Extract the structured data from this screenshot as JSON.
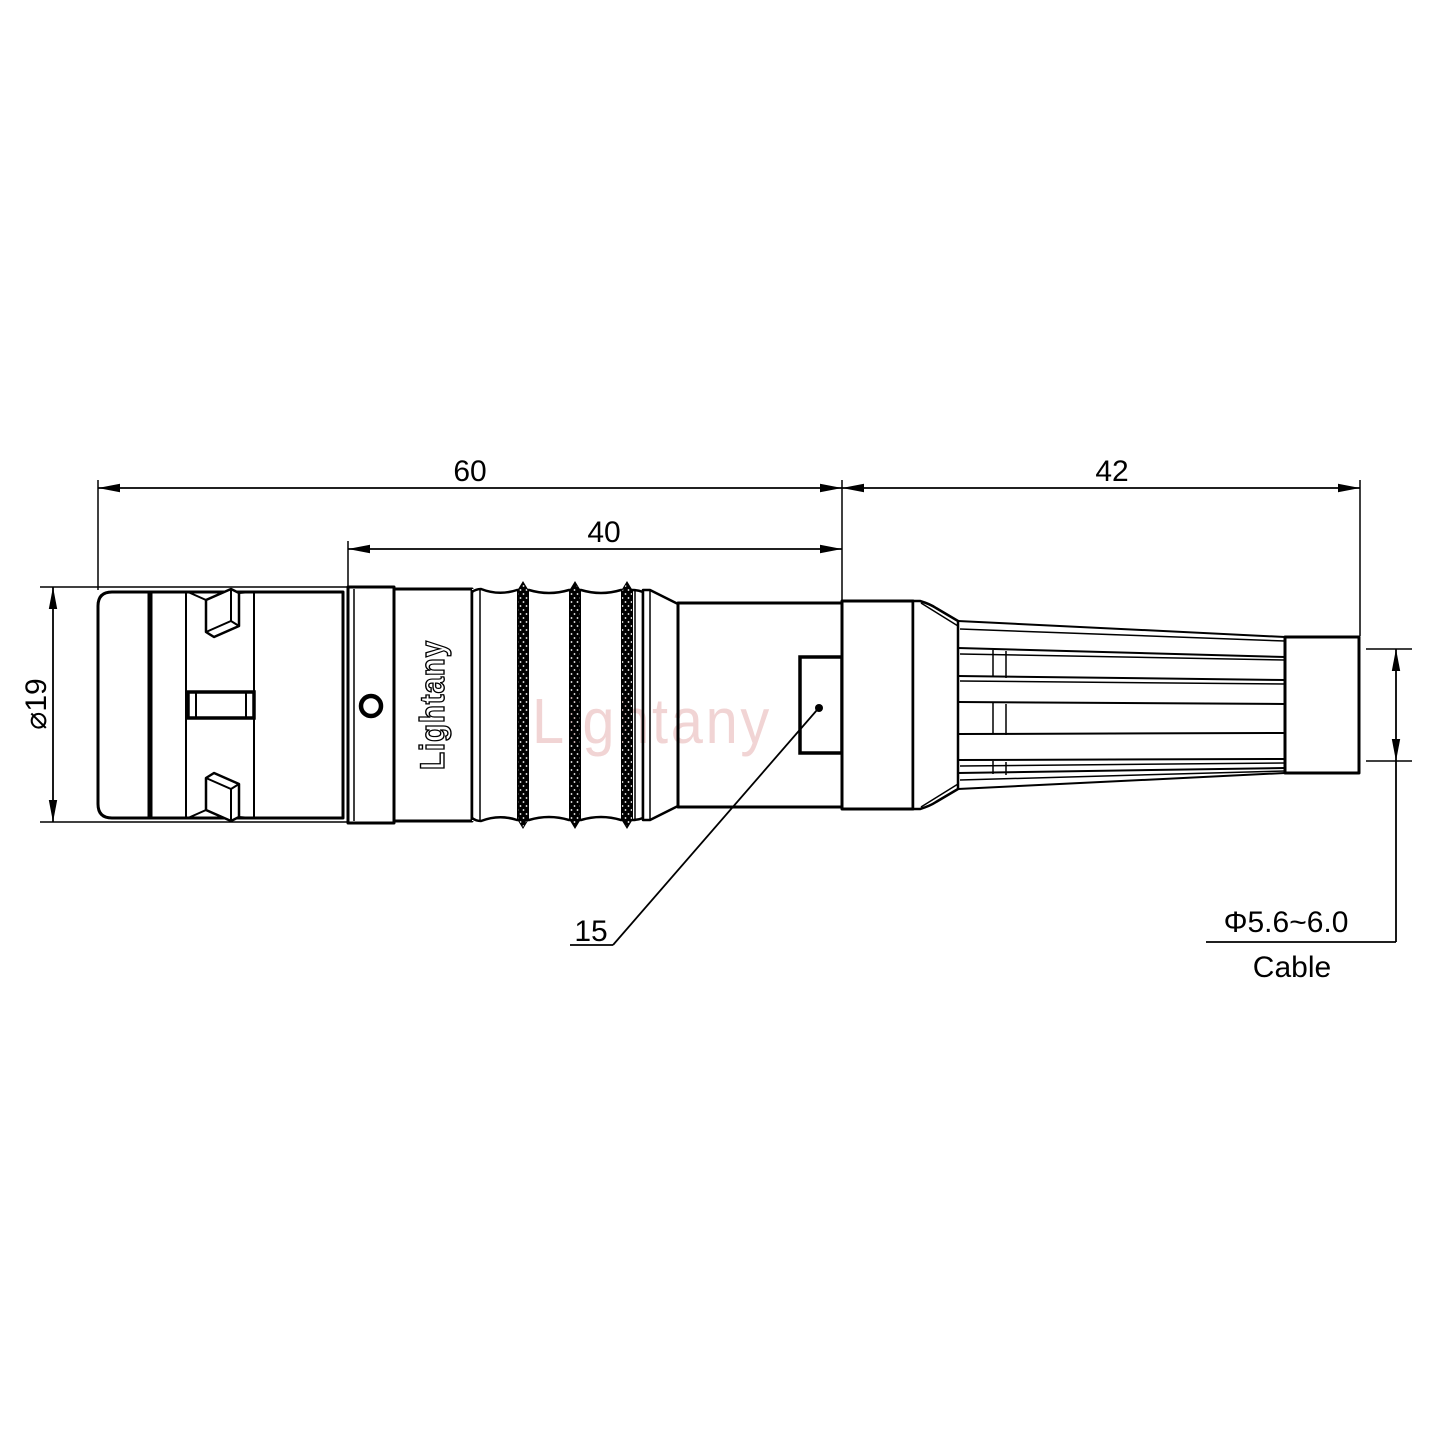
{
  "page": {
    "background": "#ffffff",
    "line_color": "#000000",
    "watermark_color": "#d98c8c"
  },
  "watermark": {
    "text": "Lightany"
  },
  "connector": {
    "engraving": "Lightany"
  },
  "dimensions": {
    "total_length": "60",
    "mid_length": "40",
    "boot_length": "42",
    "body_diameter": "⌀19",
    "rear_feature": "15",
    "cable_diameter": "Φ5.6~6.0",
    "cable_label": "Cable"
  }
}
